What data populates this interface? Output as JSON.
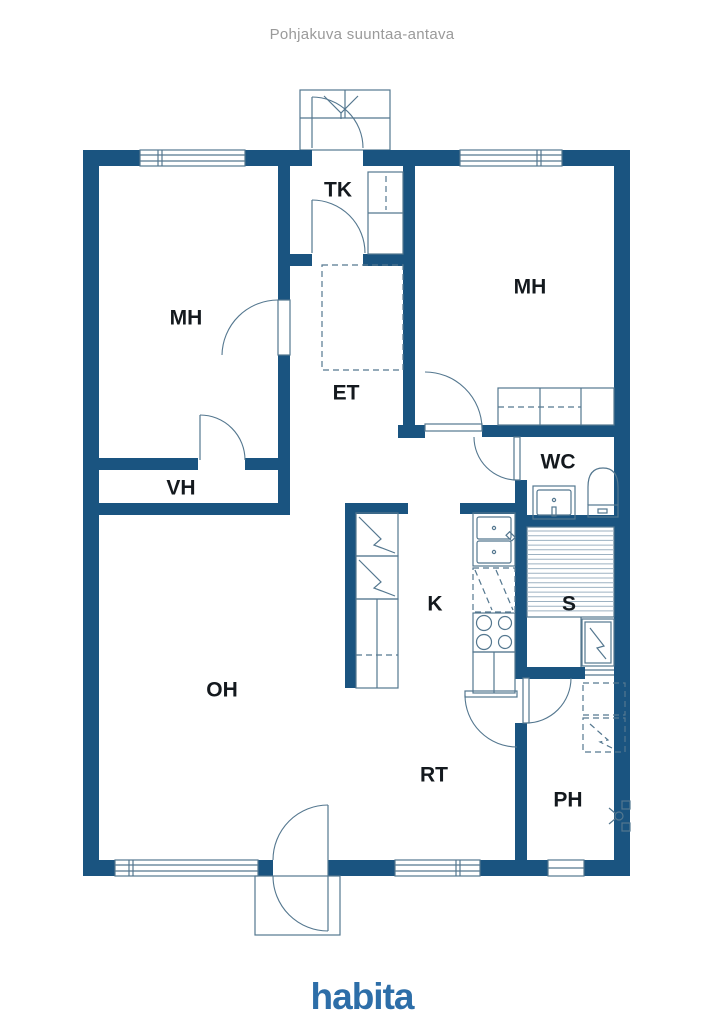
{
  "title": "Pohjakuva suuntaa-antava",
  "brand": "habita",
  "rooms": {
    "tk": "TK",
    "mh_left": "MH",
    "mh_right": "MH",
    "et": "ET",
    "vh": "VH",
    "wc": "WC",
    "k": "K",
    "s": "S",
    "oh": "OH",
    "rt": "RT",
    "ph": "PH"
  },
  "colors": {
    "wall": "#1a5480",
    "line": "#54778f",
    "bench_hatch": "#9db2c2",
    "label": "#14191e",
    "title_text": "#9a9a9a",
    "brand_logo": "#2d6ea8"
  }
}
